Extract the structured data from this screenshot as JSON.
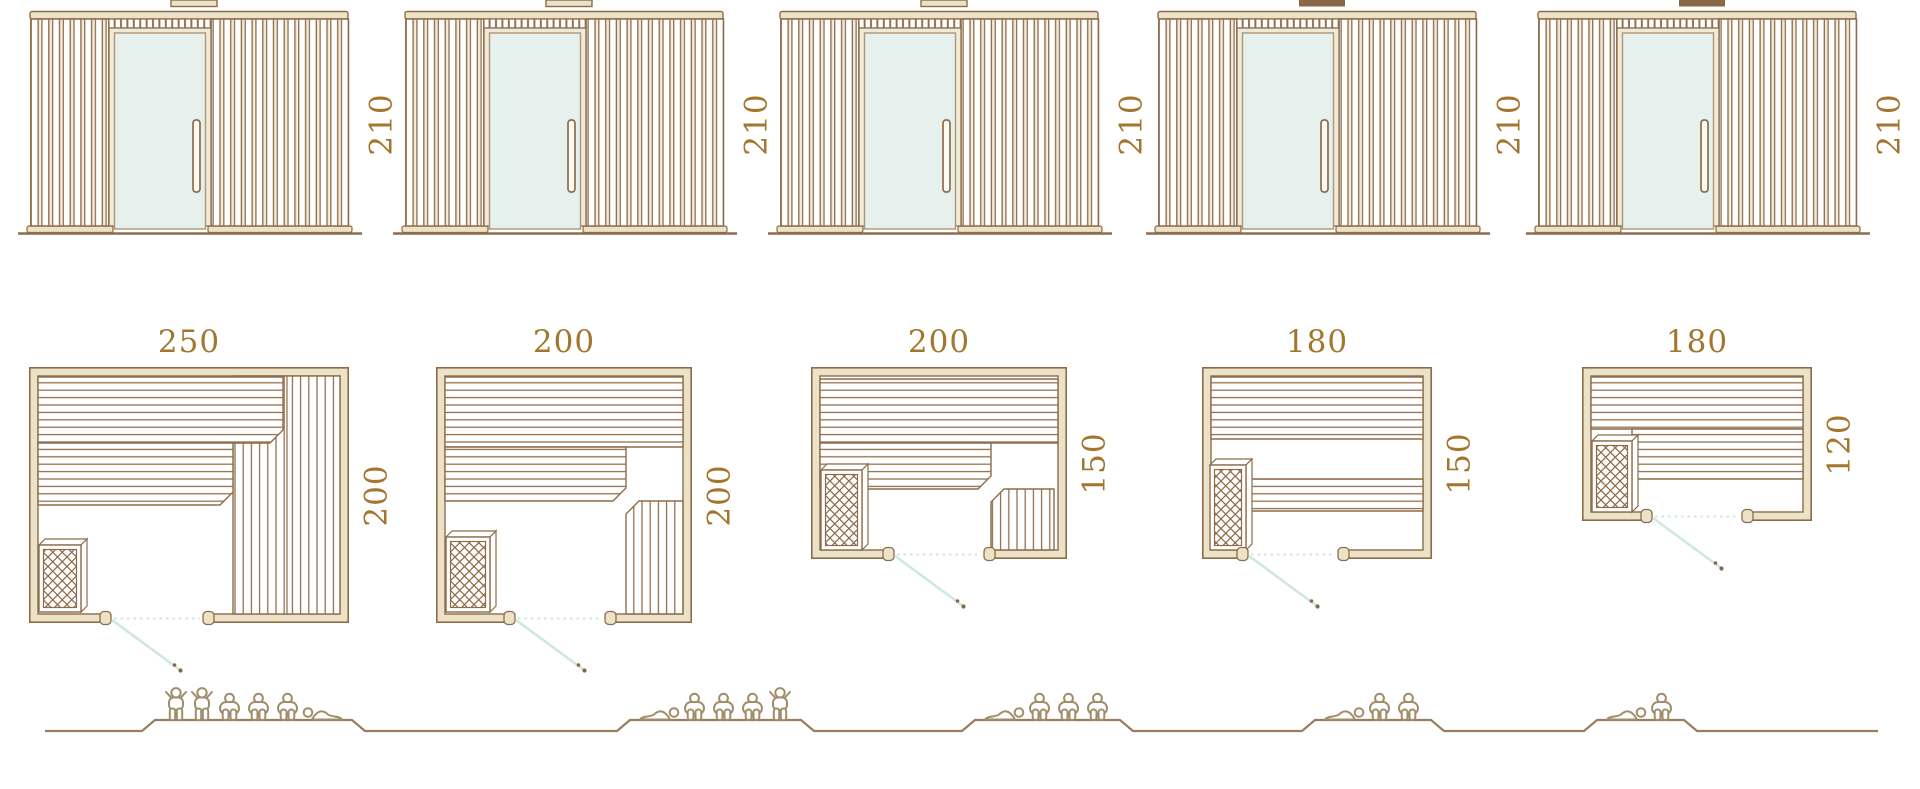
{
  "colors": {
    "line_brown": "#8E6C4A",
    "label_brown": "#A3762E",
    "fill_beige": "#EBE2C8",
    "door_frame_beige": "#F0EAD8",
    "glass_teal": "#E6F1EE",
    "swing_teal": "#CFE7E2",
    "people_brown": "#A28D6B",
    "ground_brown": "#997F5C",
    "handle_dot_brown": "#8A6747",
    "vent_dark": "#8A6747"
  },
  "units": [
    {
      "elevation": {
        "height_label": "210",
        "height_cm": 210,
        "roof_vent_filled": false,
        "door_type": "glass-door",
        "handle": "vertical-bar-handle"
      },
      "plan": {
        "width_label": "250",
        "width_cm": 250,
        "depth_label": "200",
        "depth_cm": 200,
        "door_swing": "down-right",
        "features": [
          "two-tier-bench-top",
          "l-bench-right",
          "heater-bottom-left",
          "door-bottom"
        ]
      },
      "capacity": {
        "persons": 6,
        "figures": [
          "stand",
          "stand",
          "sit",
          "sit",
          "sit",
          "lie"
        ]
      }
    },
    {
      "elevation": {
        "height_label": "210",
        "height_cm": 210,
        "roof_vent_filled": false,
        "door_type": "glass-door",
        "handle": "vertical-bar-handle"
      },
      "plan": {
        "width_label": "200",
        "width_cm": 200,
        "depth_label": "200",
        "depth_cm": 200,
        "door_swing": "down-right",
        "features": [
          "two-tier-bench-top",
          "step-bench-bottom-right",
          "heater-bottom-left",
          "door-bottom"
        ]
      },
      "capacity": {
        "persons": 5,
        "figures": [
          "lie",
          "sit",
          "sit",
          "sit",
          "stand"
        ]
      }
    },
    {
      "elevation": {
        "height_label": "210",
        "height_cm": 210,
        "roof_vent_filled": false,
        "door_type": "glass-door",
        "handle": "vertical-bar-handle"
      },
      "plan": {
        "width_label": "200",
        "width_cm": 200,
        "depth_label": "150",
        "depth_cm": 150,
        "door_swing": "down-right",
        "features": [
          "two-tier-bench-top",
          "step-bench-bottom-right",
          "heater-bottom-left",
          "door-bottom"
        ]
      },
      "capacity": {
        "persons": 4,
        "figures": [
          "lie",
          "sit",
          "sit",
          "sit"
        ]
      }
    },
    {
      "elevation": {
        "height_label": "210",
        "height_cm": 210,
        "roof_vent_filled": true,
        "door_type": "glass-door",
        "handle": "vertical-bar-handle"
      },
      "plan": {
        "width_label": "180",
        "width_cm": 180,
        "depth_label": "150",
        "depth_cm": 150,
        "door_swing": "down-right",
        "features": [
          "bench-top",
          "lower-bench",
          "heater-bottom-left",
          "door-bottom"
        ]
      },
      "capacity": {
        "persons": 3,
        "figures": [
          "lie",
          "sit",
          "sit"
        ]
      }
    },
    {
      "elevation": {
        "height_label": "210",
        "height_cm": 210,
        "roof_vent_filled": true,
        "door_type": "glass-door",
        "handle": "vertical-bar-handle"
      },
      "plan": {
        "width_label": "180",
        "width_cm": 180,
        "depth_label": "120",
        "depth_cm": 120,
        "door_swing": "down-right",
        "features": [
          "bench-top",
          "lower-bench",
          "heater-bottom-left",
          "door-bottom"
        ]
      },
      "capacity": {
        "persons": 2,
        "figures": [
          "lie",
          "sit"
        ]
      }
    }
  ]
}
